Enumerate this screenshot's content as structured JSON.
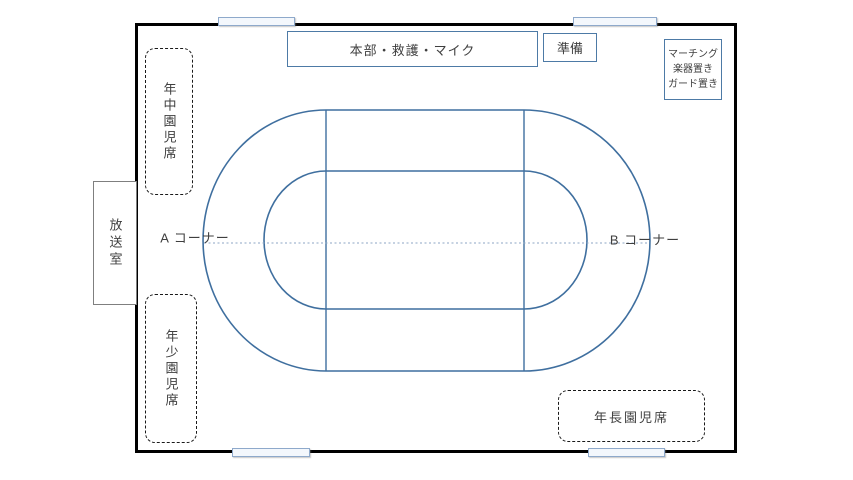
{
  "diagram": {
    "type": "sports-day field layout plan",
    "labels": {
      "hq_box": "本部・救護・マイク",
      "prep_box": "準備",
      "marching_box": {
        "line1": "マーチング",
        "line2": "楽器置き",
        "line3": "ガード置き"
      },
      "broadcast_room": "放送室",
      "seat_nenchu": "年中園児席",
      "seat_nensho": "年少園児席",
      "seat_nencho": "年長園児席",
      "corner_a": "A コーナー",
      "corner_b": "B コーナー"
    },
    "colors": {
      "field_border": "#000000",
      "track_line": "#3f6f9f",
      "center_line": "#8ca6c4",
      "box_border_blue": "#4d7aa6",
      "broadcast_border": "#7f7f7f",
      "gate_fill": "#f3f7fc",
      "gate_border": "#8ea9cb",
      "text": "#3f3f3f",
      "background": "#ffffff"
    }
  }
}
